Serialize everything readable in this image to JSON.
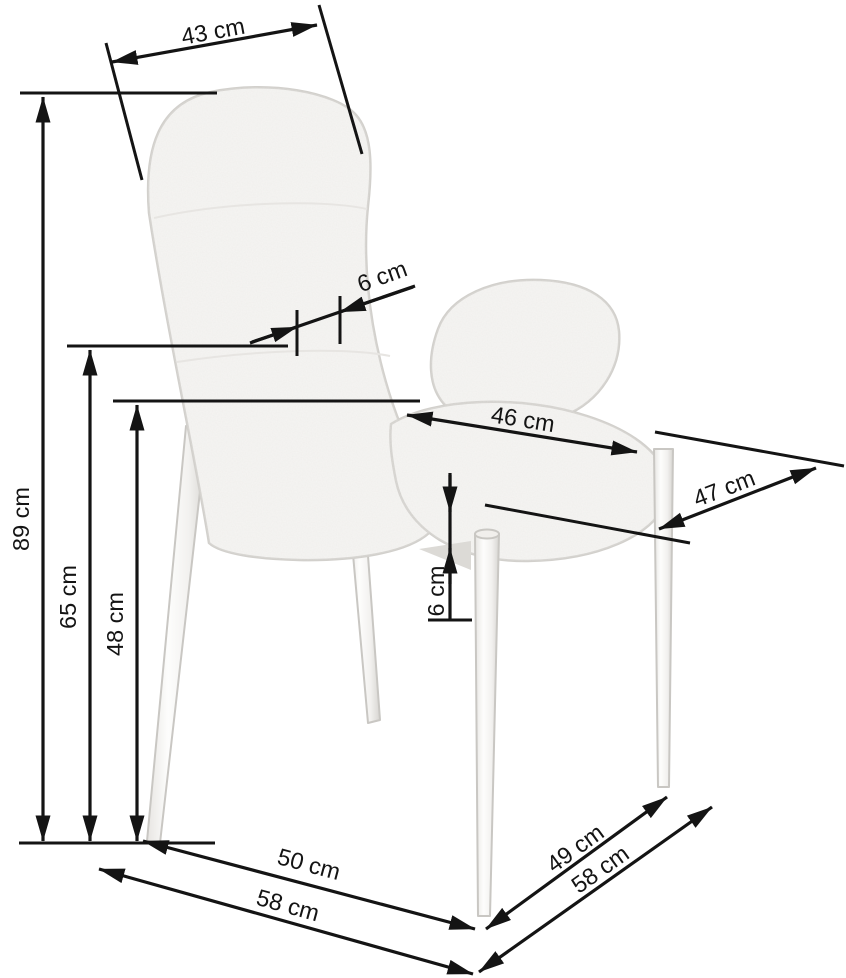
{
  "diagram": {
    "subject": "Upholstered dining chair with tapered metal legs — dimension drawing",
    "unit": "cm",
    "colors": {
      "background": "#ffffff",
      "dimension_lines": "#141414",
      "label_text": "#141414",
      "chair_fill": "#f6f5f3",
      "chair_outline": "#d2d0cc"
    },
    "measurements": {
      "backrest_width": {
        "label": "43 cm",
        "value": 43
      },
      "backrest_thickness": {
        "label": "6 cm",
        "value": 6
      },
      "overall_height": {
        "label": "89 cm",
        "value": 89
      },
      "backrest_bottom_height": {
        "label": "65 cm",
        "value": 65
      },
      "seat_height": {
        "label": "48 cm",
        "value": 48
      },
      "seat_width": {
        "label": "46 cm",
        "value": 46
      },
      "seat_depth": {
        "label": "47 cm",
        "value": 47
      },
      "seat_thickness": {
        "label": "6 cm",
        "value": 6
      },
      "footprint_depth_inner": {
        "label": "50 cm",
        "value": 50
      },
      "footprint_depth_outer": {
        "label": "58 cm",
        "value": 58
      },
      "footprint_width_inner": {
        "label": "49 cm",
        "value": 49
      },
      "footprint_width_outer": {
        "label": "58 cm",
        "value": 58
      }
    }
  }
}
